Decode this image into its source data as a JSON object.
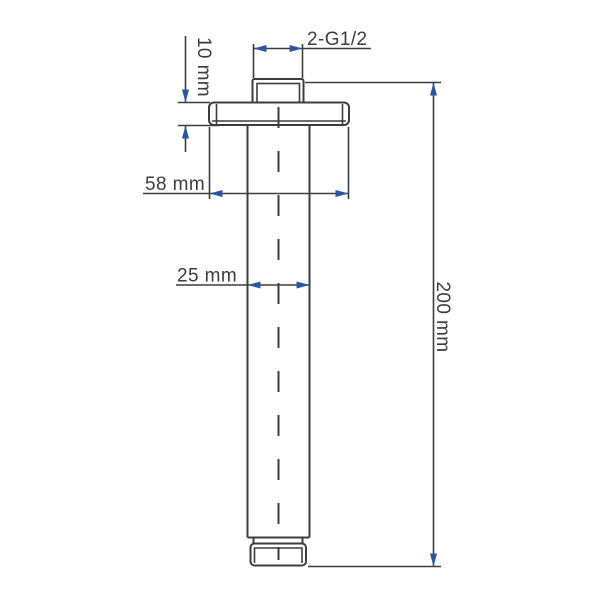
{
  "dimensions": {
    "thread": "2-G1/2",
    "flange_thickness": "10 mm",
    "flange_diameter": "58 mm",
    "pipe_diameter": "25 mm",
    "overall_length": "200 mm"
  },
  "colors": {
    "line": "#3d3d3d",
    "arrow": "#2a55a2",
    "text": "#3c3c3c",
    "background": "#ffffff"
  }
}
